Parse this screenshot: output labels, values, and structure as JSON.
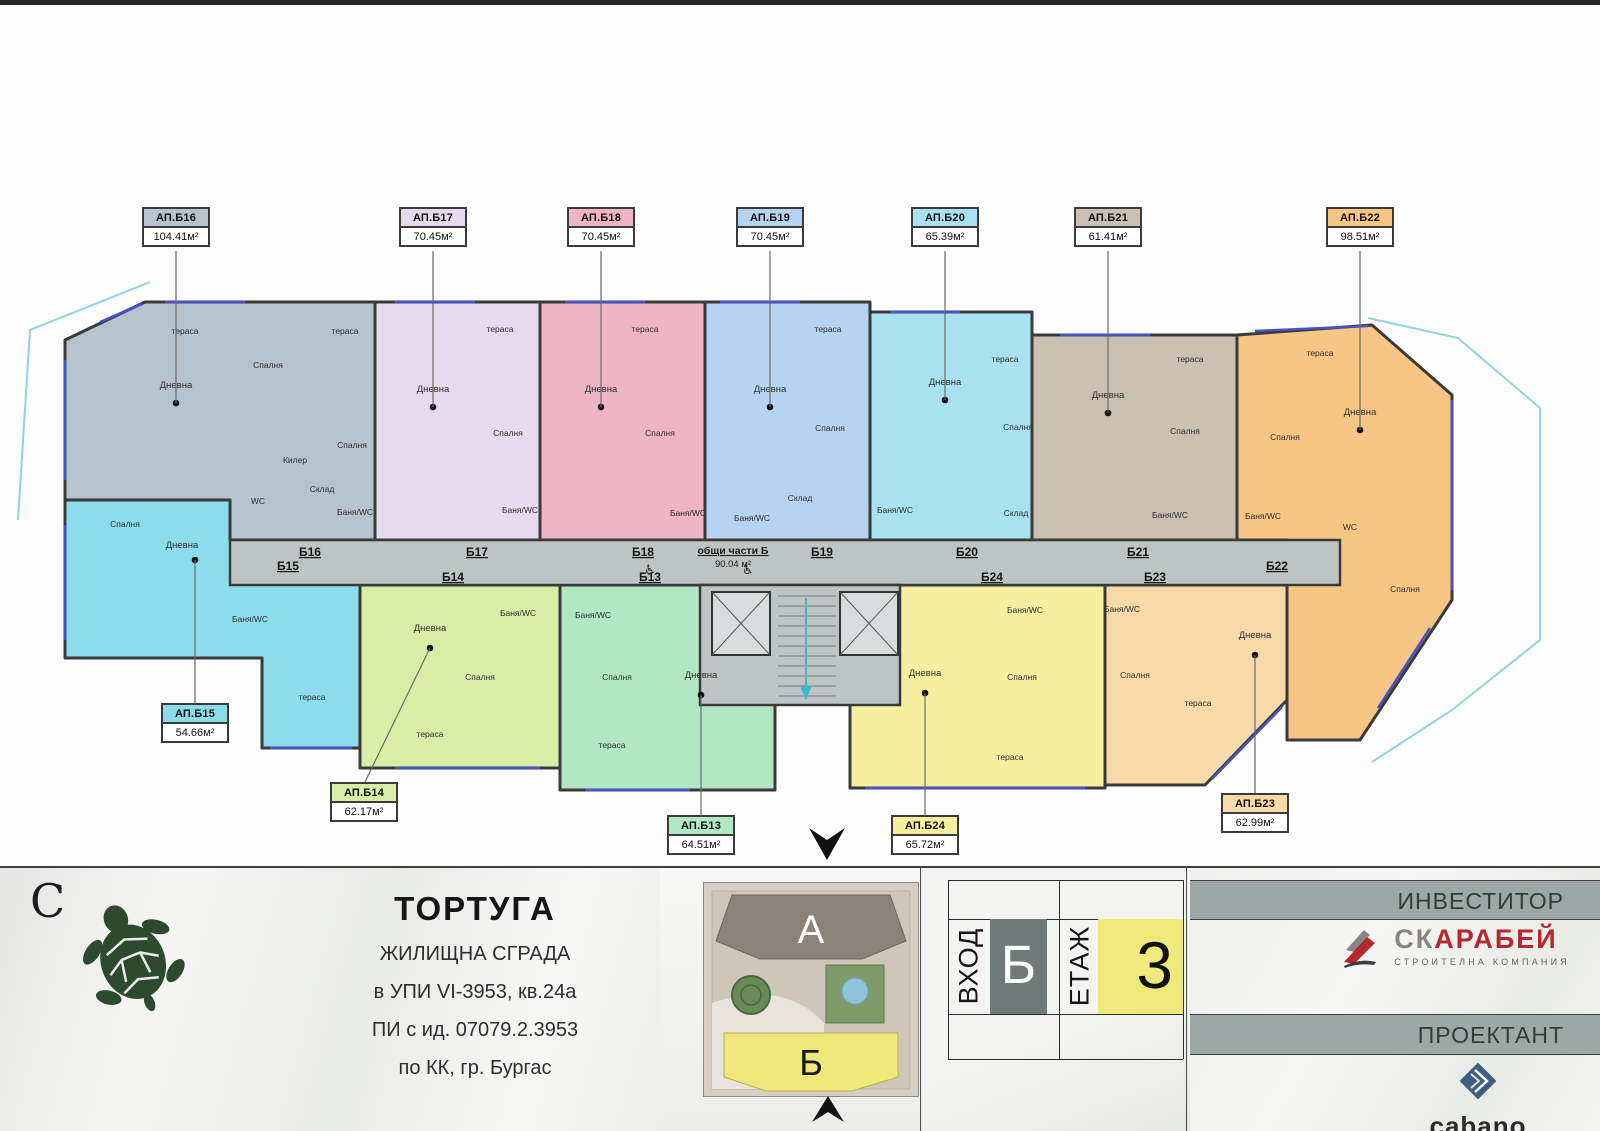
{
  "plan": {
    "common_area": {
      "line1": "общи части Б",
      "line2": "90.04 м²",
      "x": 733,
      "y": 554
    },
    "wheelchairs": [
      [
        650,
        574
      ],
      [
        748,
        574
      ]
    ],
    "door_labels": [
      {
        "t": "Б15",
        "x": 288,
        "y": 570
      },
      {
        "t": "Б16",
        "x": 310,
        "y": 556
      },
      {
        "t": "Б17",
        "x": 477,
        "y": 556
      },
      {
        "t": "Б18",
        "x": 643,
        "y": 556
      },
      {
        "t": "Б19",
        "x": 822,
        "y": 556
      },
      {
        "t": "Б20",
        "x": 967,
        "y": 556
      },
      {
        "t": "Б21",
        "x": 1138,
        "y": 556
      },
      {
        "t": "Б22",
        "x": 1277,
        "y": 570
      },
      {
        "t": "Б14",
        "x": 453,
        "y": 581
      },
      {
        "t": "Б13",
        "x": 650,
        "y": 581
      },
      {
        "t": "Б24",
        "x": 992,
        "y": 581
      },
      {
        "t": "Б23",
        "x": 1155,
        "y": 581
      }
    ],
    "windows": [
      [
        100,
        322,
        142,
        304
      ],
      [
        165,
        302,
        245,
        302
      ],
      [
        395,
        302,
        475,
        302
      ],
      [
        565,
        302,
        645,
        302
      ],
      [
        720,
        302,
        800,
        302
      ],
      [
        890,
        312,
        960,
        312
      ],
      [
        1060,
        335,
        1150,
        335
      ],
      [
        1255,
        331,
        1368,
        326
      ],
      [
        1452,
        400,
        1452,
        590
      ],
      [
        65,
        360,
        65,
        480
      ],
      [
        65,
        525,
        65,
        640
      ],
      [
        270,
        748,
        352,
        748
      ],
      [
        395,
        768,
        540,
        768
      ],
      [
        585,
        790,
        690,
        790
      ],
      [
        865,
        788,
        1085,
        788
      ],
      [
        1212,
        779,
        1282,
        707
      ],
      [
        1430,
        628,
        1378,
        708
      ]
    ],
    "apartments": [
      {
        "id": "b16",
        "name": "АП.Б16",
        "area": "104.41м²",
        "color": "#b5c3ce",
        "poly": "65,340 145,302 375,302 375,540 230,540 230,500 65,500",
        "box": {
          "x": 176,
          "y": 207
        },
        "dot": {
          "x": 176,
          "y": 403
        },
        "rooms": [
          [
            "тераса",
            185,
            334
          ],
          [
            "Спалня",
            268,
            368
          ],
          [
            "тераса",
            345,
            334
          ],
          [
            "Дневна",
            176,
            388
          ],
          [
            "Спалня",
            352,
            448
          ],
          [
            "Килер",
            295,
            463
          ],
          [
            "Склад",
            322,
            492
          ],
          [
            "WC",
            258,
            504
          ],
          [
            "Баня/WC",
            355,
            515
          ]
        ]
      },
      {
        "id": "b17",
        "name": "АП.Б17",
        "area": "70.45м²",
        "color": "#e6daef",
        "poly": "375,302 540,302 540,540 375,540",
        "box": {
          "x": 433,
          "y": 207
        },
        "dot": {
          "x": 433,
          "y": 407
        },
        "rooms": [
          [
            "тераса",
            500,
            332
          ],
          [
            "Дневна",
            433,
            392
          ],
          [
            "Спалня",
            508,
            436
          ],
          [
            "Баня/WC",
            520,
            513
          ]
        ]
      },
      {
        "id": "b18",
        "name": "АП.Б18",
        "area": "70.45м²",
        "color": "#efb4c5",
        "poly": "540,302 705,302 705,540 540,540",
        "box": {
          "x": 601,
          "y": 207
        },
        "dot": {
          "x": 601,
          "y": 407
        },
        "rooms": [
          [
            "тераса",
            645,
            332
          ],
          [
            "Дневна",
            601,
            392
          ],
          [
            "Спалня",
            660,
            436
          ],
          [
            "Баня/WC",
            688,
            516
          ]
        ]
      },
      {
        "id": "b19",
        "name": "АП.Б19",
        "area": "70.45м²",
        "color": "#b6d4f2",
        "poly": "705,302 870,302 870,540 705,540",
        "box": {
          "x": 770,
          "y": 207
        },
        "dot": {
          "x": 770,
          "y": 407
        },
        "rooms": [
          [
            "тераса",
            828,
            332
          ],
          [
            "Дневна",
            770,
            392
          ],
          [
            "Спалня",
            830,
            431
          ],
          [
            "Склад",
            800,
            501
          ],
          [
            "Баня/WC",
            752,
            521
          ]
        ]
      },
      {
        "id": "b20",
        "name": "АП.Б20",
        "area": "65.39м²",
        "color": "#aae1f0",
        "poly": "870,312 1032,312 1032,540 870,540",
        "box": {
          "x": 945,
          "y": 207
        },
        "dot": {
          "x": 945,
          "y": 400
        },
        "rooms": [
          [
            "тераса",
            1005,
            362
          ],
          [
            "Дневна",
            945,
            385
          ],
          [
            "Спалня",
            1018,
            430
          ],
          [
            "Склад",
            1016,
            516
          ],
          [
            "Баня/WC",
            895,
            513
          ]
        ]
      },
      {
        "id": "b21",
        "name": "АП.Б21",
        "area": "61.41м²",
        "color": "#c9c0b1",
        "poly": "1032,335 1237,335 1237,540 1032,540",
        "box": {
          "x": 1108,
          "y": 207
        },
        "dot": {
          "x": 1108,
          "y": 413
        },
        "rooms": [
          [
            "тераса",
            1190,
            362
          ],
          [
            "Дневна",
            1108,
            398
          ],
          [
            "Спалня",
            1185,
            434
          ],
          [
            "Баня/WC",
            1170,
            518
          ]
        ]
      },
      {
        "id": "b22",
        "name": "АП.Б22",
        "area": "98.51м²",
        "color": "#f7c685",
        "poly": "1237,335 1372,325 1452,395 1452,600 1360,740 1287,740 1287,540 1237,540",
        "box": {
          "x": 1360,
          "y": 207
        },
        "dot": {
          "x": 1360,
          "y": 430
        },
        "rooms": [
          [
            "тераса",
            1320,
            356
          ],
          [
            "Дневна",
            1360,
            415
          ],
          [
            "Спалня",
            1285,
            440
          ],
          [
            "Баня/WC",
            1263,
            519
          ],
          [
            "WC",
            1350,
            530
          ],
          [
            "Спалня",
            1405,
            592
          ]
        ]
      },
      {
        "id": "b15",
        "name": "АП.Б15",
        "area": "54.66м²",
        "color": "#8cdcec",
        "poly": "65,500 230,500 230,540 360,540 360,748 262,748 262,658 65,658",
        "box": {
          "x": 195,
          "y": 703
        },
        "dot": {
          "x": 195,
          "y": 560
        },
        "rooms": [
          [
            "Спалня",
            125,
            527
          ],
          [
            "Дневна",
            182,
            548
          ],
          [
            "Баня/WC",
            250,
            622
          ],
          [
            "тераса",
            312,
            700
          ]
        ]
      },
      {
        "id": "b14",
        "name": "АП.Б14",
        "area": "62.17м²",
        "color": "#d9eda7",
        "poly": "360,585 560,585 560,768 360,768",
        "box": {
          "x": 364,
          "y": 782
        },
        "dot": {
          "x": 430,
          "y": 648
        },
        "rooms": [
          [
            "Дневна",
            430,
            631
          ],
          [
            "Баня/WC",
            518,
            616
          ],
          [
            "Спалня",
            480,
            680
          ],
          [
            "тераса",
            430,
            737
          ]
        ]
      },
      {
        "id": "b13",
        "name": "АП.Б13",
        "area": "64.51м²",
        "color": "#b1e8c3",
        "poly": "560,585 715,585 715,655 775,655 775,790 560,790",
        "box": {
          "x": 701,
          "y": 815
        },
        "dot": {
          "x": 701,
          "y": 695
        },
        "rooms": [
          [
            "Баня/WC",
            593,
            618
          ],
          [
            "Спалня",
            617,
            680
          ],
          [
            "Дневна",
            701,
            678
          ],
          [
            "тераса",
            612,
            748
          ]
        ]
      },
      {
        "id": "b24",
        "name": "АП.Б24",
        "area": "65.72м²",
        "color": "#f5ef9f",
        "poly": "850,585 1105,585 1105,788 850,788",
        "box": {
          "x": 925,
          "y": 815
        },
        "dot": {
          "x": 925,
          "y": 693
        },
        "rooms": [
          [
            "Дневна",
            925,
            676
          ],
          [
            "Баня/WC",
            1025,
            613
          ],
          [
            "Спалня",
            1022,
            680
          ],
          [
            "тераса",
            1010,
            760
          ]
        ]
      },
      {
        "id": "b23",
        "name": "АП.Б23",
        "area": "62.99м²",
        "color": "#f8d9a9",
        "poly": "1105,585 1287,585 1287,700 1205,785 1105,785",
        "box": {
          "x": 1255,
          "y": 793
        },
        "dot": {
          "x": 1255,
          "y": 655
        },
        "rooms": [
          [
            "Баня/WC",
            1122,
            612
          ],
          [
            "Дневна",
            1255,
            638
          ],
          [
            "Спалня",
            1135,
            678
          ],
          [
            "тераса",
            1198,
            706
          ]
        ]
      }
    ]
  },
  "footer": {
    "north_letter": "С",
    "brand": {
      "title": "ТОРТУГА",
      "line1": "ЖИЛИЩНА СГРАДА",
      "line2": "в УПИ VI-3953, кв.24а",
      "line3": "ПИ с ид. 07079.2.3953",
      "line4": "по КК, гр. Бургас"
    },
    "siteplan": {
      "building_a": "А",
      "building_b": "Б"
    },
    "entrance": {
      "label": "ВХОД",
      "value": "Б"
    },
    "floor": {
      "label": "ЕТАЖ",
      "value": "3"
    },
    "investor": {
      "label": "ИНВЕСТИТОР",
      "name_gray": "СК",
      "name_red": "АРАБЕЙ",
      "subtitle": "СТРОИТЕЛНА  КОМПАНИЯ"
    },
    "designer": {
      "label": "ПРОЕКТАНТ",
      "name": "cabano"
    }
  },
  "colors": {
    "corridor": "#bdc4c3",
    "wall": "#3a3a3a",
    "window_blue": "#4653c8",
    "entrance_box": "#6e7b79",
    "floor_box": "#efe87b",
    "header_bar": "#9ba8a5",
    "scarab_red": "#b5282d",
    "scarab_gray": "#8a8580",
    "cabano_blue": "#3f5e7e",
    "site_building_a": "#8b8278",
    "site_building_b": "#eee77c"
  }
}
